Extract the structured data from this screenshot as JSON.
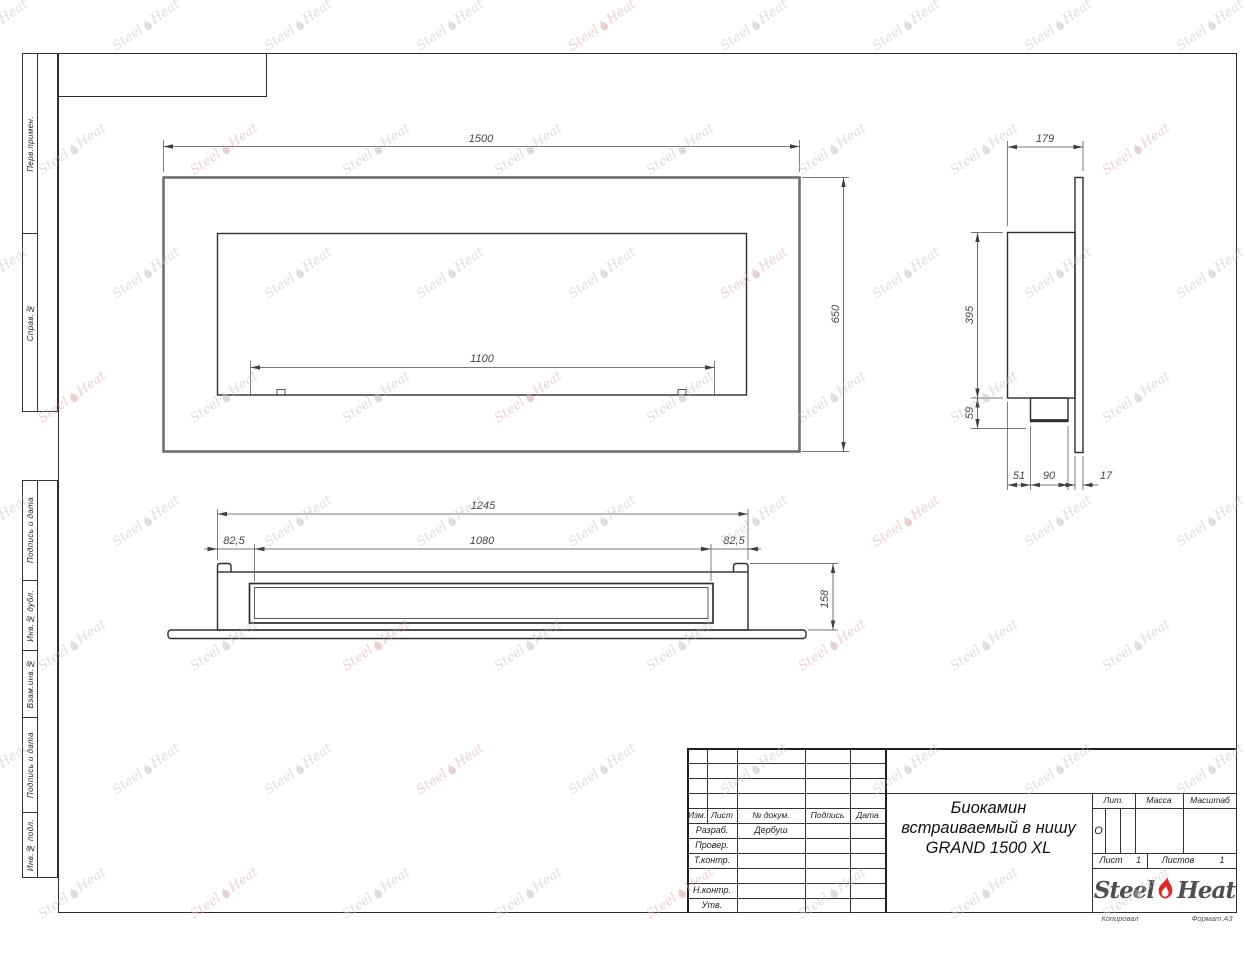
{
  "frame": {
    "copied_note": "Копировал",
    "format_note": "Формат А3"
  },
  "stamp": {
    "g1": [
      "Перв.примен.",
      "Справ.№"
    ],
    "g2": [
      "Подпись и дата",
      "Инв.№ дубл.",
      "Взам.инв.№",
      "Подпись и дата",
      "Инв.№ подл."
    ]
  },
  "tb": {
    "cols": [
      "Изм.",
      "Лист",
      "№ докум.",
      "Подпись",
      "Дата"
    ],
    "sig_rows": [
      {
        "label": "Разраб.",
        "value": "Дербуш"
      },
      {
        "label": "Провер.",
        "value": ""
      },
      {
        "label": "Т.контр.",
        "value": ""
      },
      {
        "label": "Н.контр.",
        "value": ""
      },
      {
        "label": "Утв.",
        "value": ""
      }
    ],
    "title_lines": [
      "Биокамин",
      "встраиваемый в нишу",
      "GRAND 1500 XL"
    ],
    "lit": {
      "label": "Лит.",
      "value": "О"
    },
    "mass_label": "Масса",
    "scale_label": "Масштаб",
    "sheet": {
      "label": "Лист",
      "value": "1"
    },
    "sheets": {
      "label": "Листов",
      "value": "1"
    },
    "logo": {
      "left": "Steel",
      "right": "Heat",
      "flame_color": "#e2251f",
      "text_color": "#4f4f4f"
    }
  },
  "dims": {
    "front_width": "1500",
    "front_height": "650",
    "front_opening": "1100",
    "side_depth": "179",
    "side_height": "395",
    "side_bottom": "59",
    "side_seg1": "51",
    "side_seg2": "90",
    "side_seg3": "17",
    "bottom_width": "1245",
    "bottom_left": "82,5",
    "bottom_opening": "1080",
    "bottom_right": "82,5",
    "bottom_depth": "158"
  },
  "watermark": {
    "left": "Steel",
    "right": "Heat",
    "gray": "#bdbdbd",
    "pink": "#dba3a0"
  },
  "colors": {
    "line": "#2e2e2e",
    "dim": "#474747",
    "frame": "#2b2b2b"
  }
}
